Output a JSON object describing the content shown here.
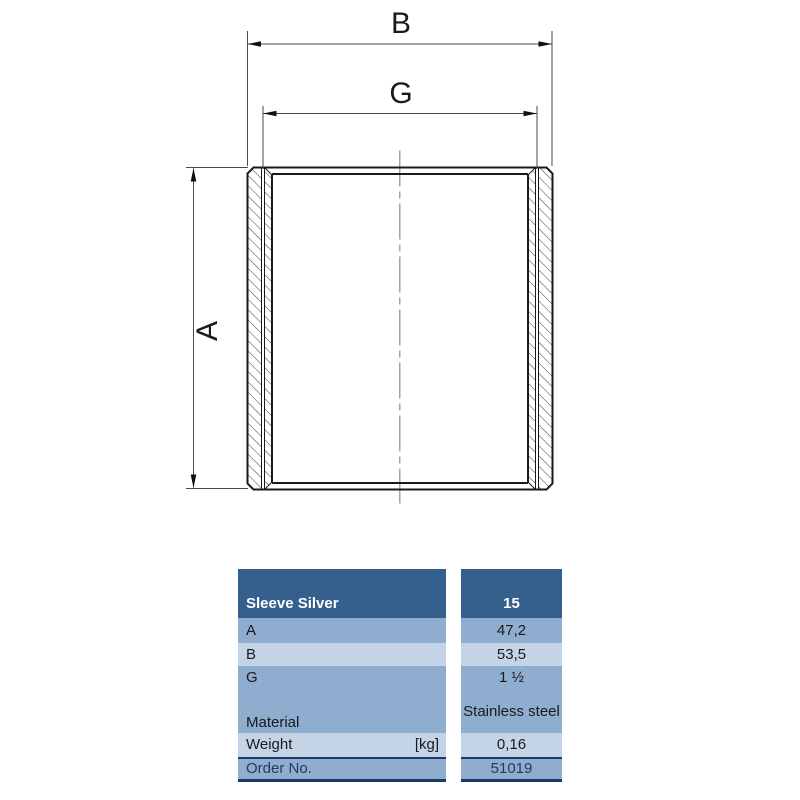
{
  "drawing": {
    "type": "technical-cross-section",
    "part": "threaded sleeve / socket",
    "dim_labels": {
      "outer_width": "B",
      "thread_width": "G",
      "height": "A"
    }
  },
  "table": {
    "header": {
      "product": "Sleeve Silver",
      "size": "15"
    },
    "rows": [
      {
        "label": "A",
        "unit": "",
        "value": "47,2"
      },
      {
        "label": "B",
        "unit": "",
        "value": "53,5"
      },
      {
        "label": "G",
        "unit": "",
        "value": "1 ½"
      },
      {
        "label": "Material",
        "unit": "",
        "value": "Stainless steel"
      },
      {
        "label": "Weight",
        "unit": "[kg]",
        "value": "0,16"
      }
    ],
    "footer": {
      "label": "Order No.",
      "value": "51019"
    }
  },
  "colors": {
    "header_bg": "#35608e",
    "row_medium": "#8fadce",
    "row_light": "#c4d3e6",
    "order_border": "#1c3a63",
    "order_text": "#1e3c69",
    "line_black": "#1a1a1a",
    "centerline_gray": "#8f8f8f"
  }
}
